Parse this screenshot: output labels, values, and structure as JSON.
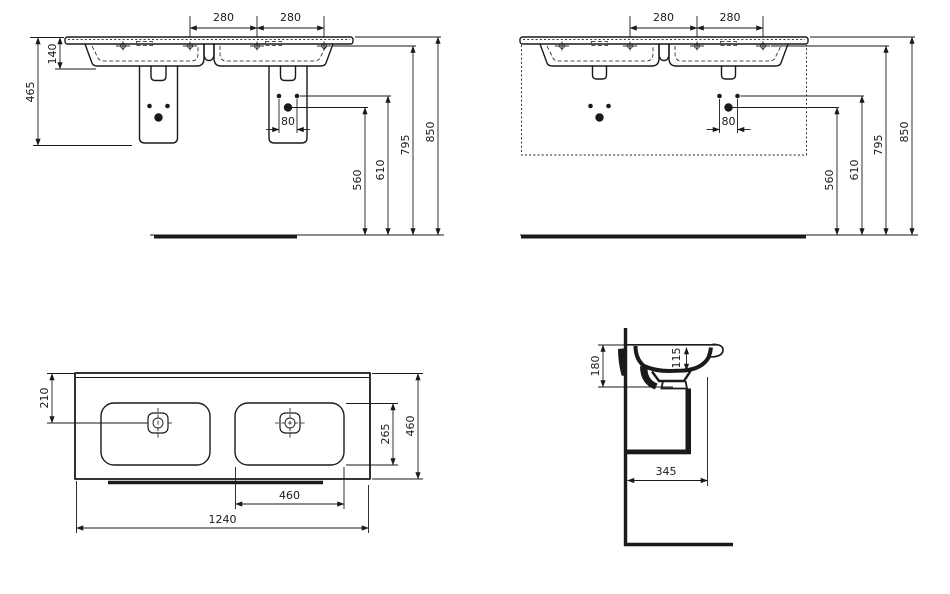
{
  "drawing": {
    "kind": "washbasin-dimension-drawing",
    "line_color": "#1a1a1a",
    "background": "#ffffff"
  },
  "views": {
    "front_pedestal": {
      "dims": {
        "pitch_left": "280",
        "pitch_right": "280",
        "rim_to_bowl": "140",
        "ceramic_height": "465",
        "hole_spacing": "80",
        "big_hole": "560",
        "small_hole": "610",
        "faucet": "795",
        "rim": "850"
      }
    },
    "front_furniture": {
      "dims": {
        "pitch_left": "280",
        "pitch_right": "280",
        "hole_spacing": "80",
        "big_hole": "560",
        "small_hole": "610",
        "faucet": "795",
        "rim": "850"
      }
    },
    "plan": {
      "dims": {
        "drain_from_back": "210",
        "bowl_depth": "265",
        "overall_depth": "460",
        "bowl_width": "460",
        "overall_width": "1240"
      }
    },
    "side": {
      "dims": {
        "apron_height": "180",
        "bowl_inner_depth": "115",
        "drain_from_wall": "345"
      }
    }
  }
}
